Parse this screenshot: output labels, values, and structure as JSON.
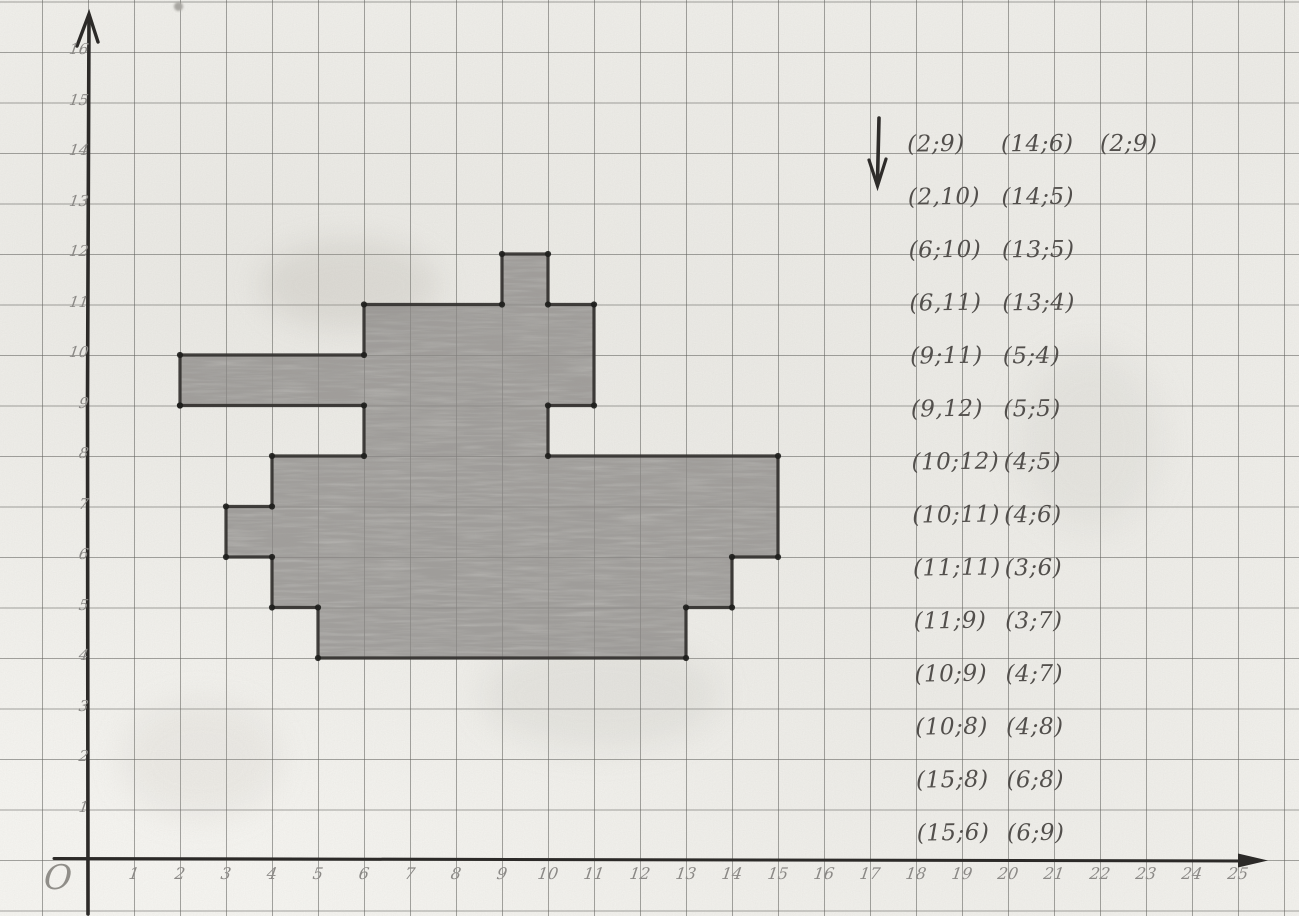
{
  "paper": {
    "background": "#f6f5f1",
    "grid_color": "#5c5c58",
    "pencil_outline_color": "#33312f",
    "pencil_fill_color": "#8d8b88",
    "pencil_label_color": "#8b8986",
    "handwriting_color": "#524f4c"
  },
  "axes": {
    "origin_label": "O",
    "x_tick_labels": [
      "1",
      "2",
      "3",
      "4",
      "5",
      "6",
      "7",
      "8",
      "9",
      "10",
      "11",
      "12",
      "13",
      "14",
      "15",
      "16",
      "17",
      "18",
      "19",
      "20",
      "21",
      "22",
      "23",
      "24",
      "25"
    ],
    "y_tick_labels": [
      "1",
      "2",
      "3",
      "4",
      "5",
      "6",
      "7",
      "8",
      "9",
      "10",
      "11",
      "12",
      "13",
      "14",
      "15",
      "16"
    ],
    "x_axis_end_icon": "right-arrow",
    "y_axis_end_icon": "up-arrow"
  },
  "coordinate_lists": {
    "pointer_icon": "down-arrow",
    "column1": [
      "(2;9)",
      "(2,10)",
      "(6;10)",
      "(6,11)",
      "(9;11)",
      "(9,12)",
      "(10;12)",
      "(10;11)",
      "(11;11)",
      "(11;9)",
      "(10;9)",
      "(10;8)",
      "(15;8)",
      "(15;6)"
    ],
    "column2": [
      "(14;6)",
      "(14;5)",
      "(13;5)",
      "(13;4)",
      "(5;4)",
      "(5;5)",
      "(4;5)",
      "(4;6)",
      "(3;6)",
      "(3;7)",
      "(4;7)",
      "(4;8)",
      "(6;8)",
      "(6;9)"
    ],
    "column3": [
      "(2;9)"
    ]
  },
  "chart_data": {
    "type": "line",
    "title": "",
    "xlabel": "",
    "ylabel": "",
    "xlim": [
      0,
      25
    ],
    "ylim": [
      0,
      16
    ],
    "grid": true,
    "closed": true,
    "figure_description": "closed pencil-shaded polygon (tank silhouette) drawn by connecting the listed coordinate points on squared paper",
    "points": [
      [
        2,
        9
      ],
      [
        2,
        10
      ],
      [
        6,
        10
      ],
      [
        6,
        11
      ],
      [
        9,
        11
      ],
      [
        9,
        12
      ],
      [
        10,
        12
      ],
      [
        10,
        11
      ],
      [
        11,
        11
      ],
      [
        11,
        9
      ],
      [
        10,
        9
      ],
      [
        10,
        8
      ],
      [
        15,
        8
      ],
      [
        15,
        6
      ],
      [
        14,
        6
      ],
      [
        14,
        5
      ],
      [
        13,
        5
      ],
      [
        13,
        4
      ],
      [
        5,
        4
      ],
      [
        5,
        5
      ],
      [
        4,
        5
      ],
      [
        4,
        6
      ],
      [
        3,
        6
      ],
      [
        3,
        7
      ],
      [
        4,
        7
      ],
      [
        4,
        8
      ],
      [
        6,
        8
      ],
      [
        6,
        9
      ],
      [
        2,
        9
      ]
    ]
  }
}
